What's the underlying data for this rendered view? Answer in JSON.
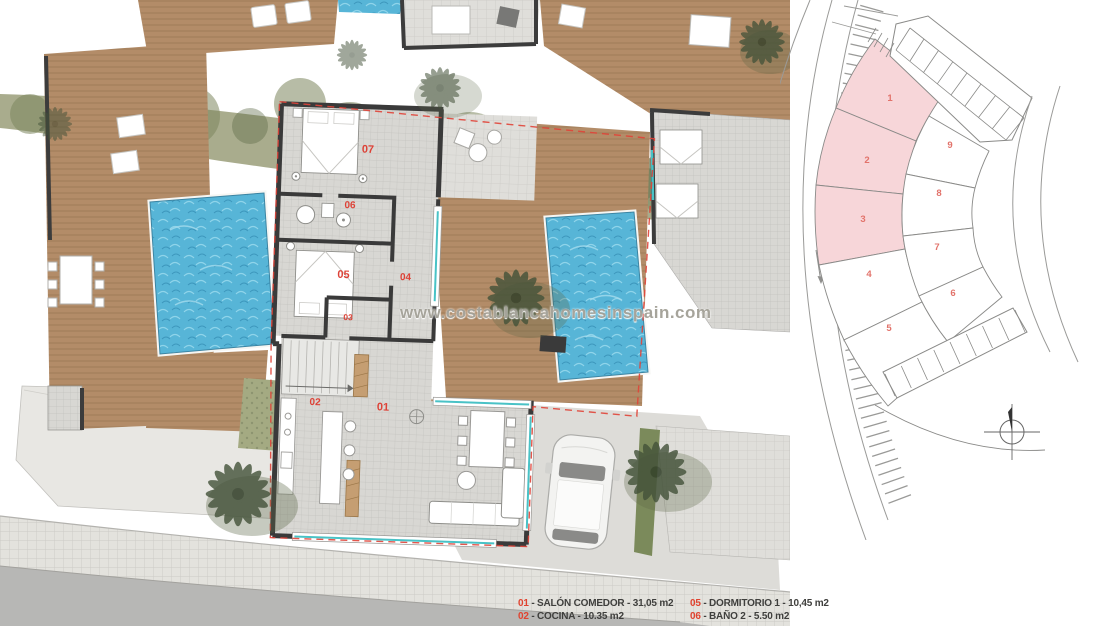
{
  "watermark": "www.costablancahomesinspain.com",
  "floor_plan": {
    "room_labels": [
      {
        "id": "07"
      },
      {
        "id": "06"
      },
      {
        "id": "05"
      },
      {
        "id": "04"
      },
      {
        "id": "03"
      },
      {
        "id": "02"
      },
      {
        "id": "01"
      }
    ]
  },
  "site_plan": {
    "plots": [
      {
        "number": "1",
        "highlighted": true
      },
      {
        "number": "2",
        "highlighted": true
      },
      {
        "number": "3",
        "highlighted": true
      },
      {
        "number": "4",
        "highlighted": false
      },
      {
        "number": "5",
        "highlighted": false
      },
      {
        "number": "6",
        "highlighted": false
      },
      {
        "number": "7",
        "highlighted": false
      },
      {
        "number": "8",
        "highlighted": false
      },
      {
        "number": "9",
        "highlighted": false
      }
    ]
  },
  "legend": {
    "separator": " - ",
    "items": [
      {
        "number": "01",
        "label": "SALÓN COMEDOR",
        "area": "31,05 m2"
      },
      {
        "number": "02",
        "label": "COCINA",
        "area": "10.35 m2"
      },
      {
        "number": "05",
        "label": "DORMITORIO 1",
        "area": "10,45 m2"
      },
      {
        "number": "06",
        "label": "BAÑO 2",
        "area": "5.50 m2"
      }
    ]
  },
  "colors": {
    "accent_red": "#dd4237",
    "plot_highlight": "#f7d6d9",
    "plot_number": "#e2736b",
    "pool_blue": "#57b5d7",
    "deck_brown": "#b38c68",
    "vegetation_olive": "#a9ac8d",
    "palm_green": "#435239",
    "wall_dark": "#3a3a3a",
    "window_teal": "#49c2c6",
    "boundary_red": "#e04438",
    "road_gray": "#b7b7b5"
  }
}
